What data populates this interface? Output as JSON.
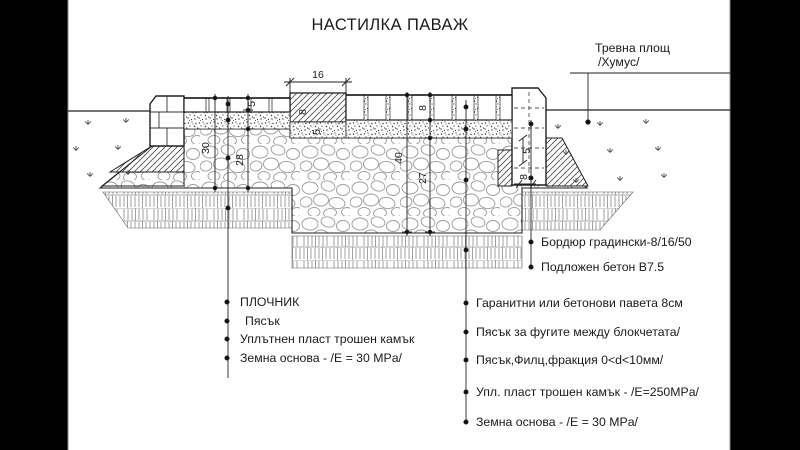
{
  "colors": {
    "letterbox": "#000000",
    "paper": "#ffffff",
    "ink": "#1b1b1b"
  },
  "title": "НАСТИЛКА ПАВАЖ",
  "annotations": {
    "grass_area": {
      "line1": "Тревна площ",
      "line2": "/Хумус/"
    },
    "curb_callouts": [
      "Бордюр градински-8/16/50",
      "Подложен бетон В7.5"
    ],
    "left_callouts": [
      "ПЛОЧНИК",
      "Пясък",
      "Уплътнен пласт трошен камък",
      "Земна основа - /Е = 30 MPa/"
    ],
    "right_callouts": [
      "Гаранитни или бетонови павета 8см",
      "Пясък за фугите между блокчетата/",
      "Пясък,Филц,фракция 0<d<10мм/",
      "Упл. пласт трошен камък - /Е=250MPa/",
      "Земна основа - /Е = 30 MPa/"
    ]
  },
  "dimensions": {
    "curb_width": "16",
    "mid_curb_height": "8",
    "mid_curb_bed": "5",
    "left_depth_total": "30",
    "left_surface": "5",
    "left_crushed_stone": "28",
    "pavement_depth_total": "40",
    "paver_height": "8",
    "crushed_stone_depth": "27",
    "curb_detail_a": "5",
    "curb_detail_b": "8"
  }
}
